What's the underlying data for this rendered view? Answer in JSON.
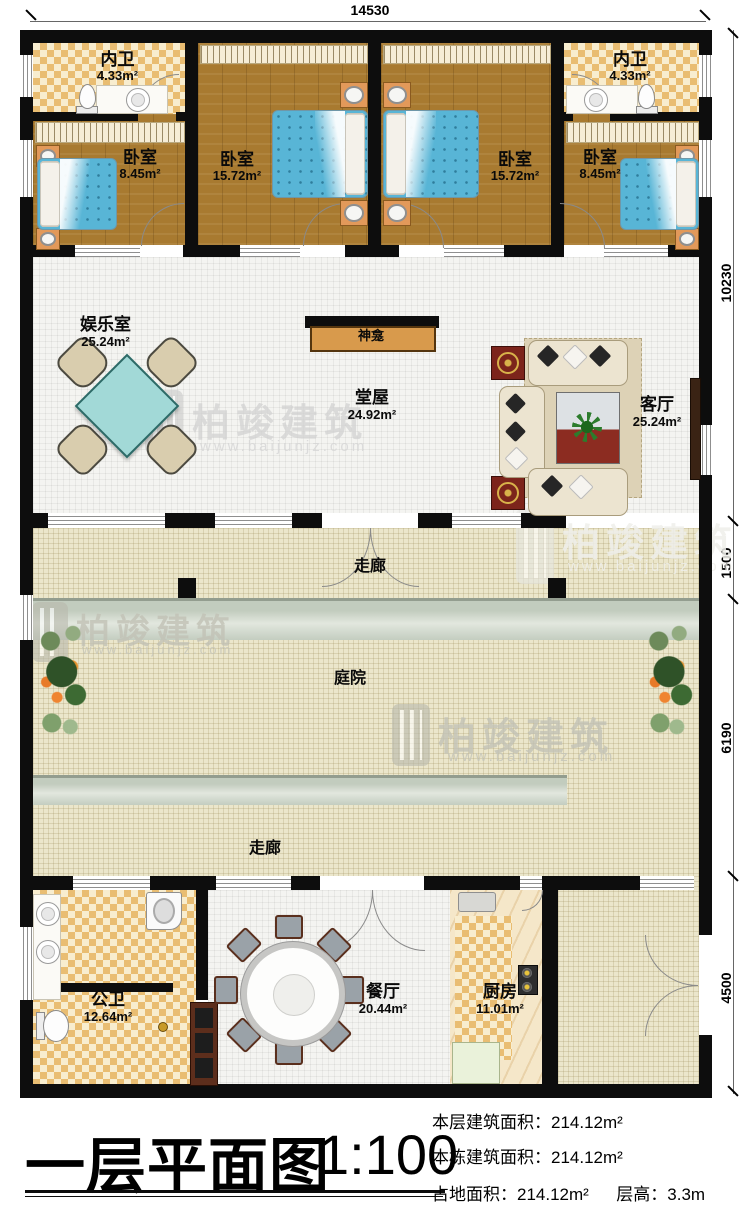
{
  "dimensions": {
    "top": "14530",
    "right": [
      "10230",
      "1500",
      "6190",
      "4500"
    ]
  },
  "rooms": [
    {
      "name": "内卫",
      "area": "4.33m²"
    },
    {
      "name": "卧室",
      "area": "8.45m²"
    },
    {
      "name": "卧室",
      "area": "15.72m²"
    },
    {
      "name": "卧室",
      "area": "15.72m²"
    },
    {
      "name": "卧室",
      "area": "8.45m²"
    },
    {
      "name": "内卫",
      "area": "4.33m²"
    },
    {
      "name": "娱乐室",
      "area": "25.24m²"
    },
    {
      "name": "堂屋",
      "area": "24.92m²"
    },
    {
      "name": "客厅",
      "area": "25.24m²"
    },
    {
      "name": "公卫",
      "area": "12.64m²"
    },
    {
      "name": "餐厅",
      "area": "20.44m²"
    },
    {
      "name": "厨房",
      "area": "11.01m²"
    }
  ],
  "labels": {
    "shrine": "神龛",
    "corridor_top": "走廊",
    "corridor_bottom": "走廊",
    "courtyard": "庭院"
  },
  "watermark": {
    "brand": "柏竣建筑",
    "url": "www.baijunjz.com"
  },
  "title_block": {
    "title": "一层平面图",
    "scale": "1:100",
    "stats": [
      {
        "label": "本层建筑面积：",
        "value": "214.12m²"
      },
      {
        "label": "本栋建筑面积：",
        "value": "214.12m²"
      },
      {
        "label": "占地面积：",
        "value": "214.12m²"
      },
      {
        "label": "层高：",
        "value": "3.3m"
      }
    ]
  }
}
